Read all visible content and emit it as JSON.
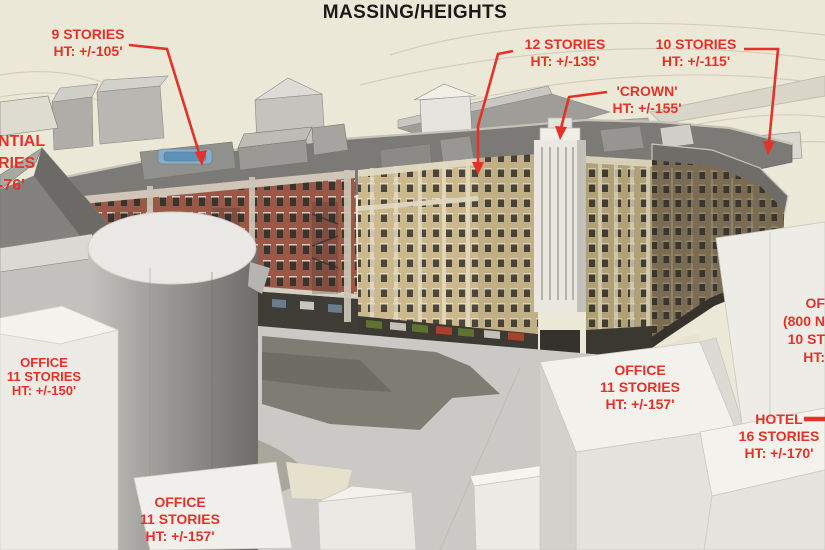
{
  "title": "MASSING/HEIGHTS",
  "colors": {
    "label_red": "#e53228",
    "title_black": "#1c1a18",
    "background_beige": "#ece8d8",
    "brick_red": "#9b5847",
    "facade_tan": "#cbb98d",
    "massing_gray": "#9a9995",
    "massing_white": "#f2f1ec"
  },
  "labels": {
    "stories9": {
      "line1": "9 STORIES",
      "line2": "HT: +/-105'"
    },
    "stories12": {
      "line1": "12 STORIES",
      "line2": "HT: +/-135'"
    },
    "stories10": {
      "line1": "10 STORIES",
      "line2": "HT: +/-115'"
    },
    "crown": {
      "line1": "'CROWN'",
      "line2": "HT: +/-155'"
    },
    "residential_cut": {
      "line1": "NTIAL",
      "line2": "RIES",
      "line3": "-76'"
    },
    "office_left": {
      "line1": "OFFICE",
      "line2": "11 STORIES",
      "line3": "HT: +/-150'"
    },
    "office_center": {
      "line1": "OFFICE",
      "line2": "11 STORIES",
      "line3": "HT: +/-157'"
    },
    "office_right_cut": {
      "line1": "OF",
      "line2": "(800 N",
      "line3": "10 ST",
      "line4": "HT:"
    },
    "hotel": {
      "line1": "HOTEL",
      "line2": "16 STORIES",
      "line3": "HT: +/-170'"
    },
    "office_bottom": {
      "line1": "OFFICE",
      "line2": "11 STORIES",
      "line3": "HT: +/-157'"
    }
  }
}
